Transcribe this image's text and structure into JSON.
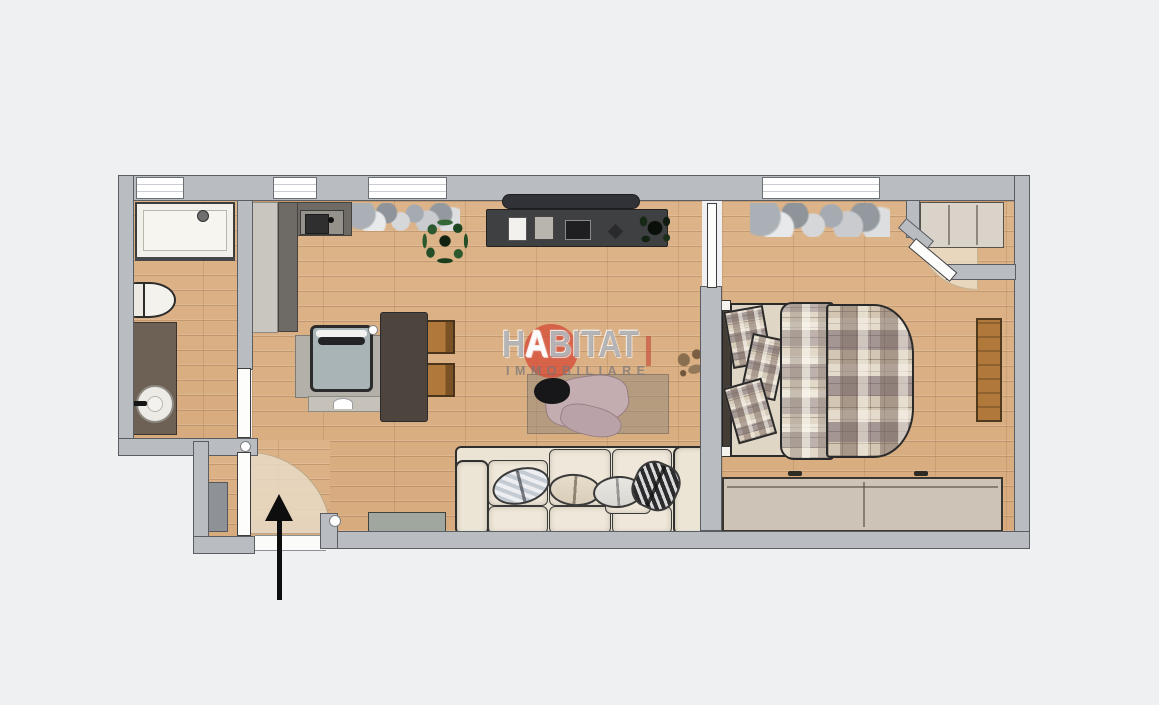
{
  "watermark": {
    "brand_part1": "H",
    "brand_part2": "A",
    "brand_part3": "BITAT",
    "subtitle": "IMMOBILIARE",
    "accent_color": "#d4503a"
  },
  "colors": {
    "background": "#eef0f2",
    "wall": "#b9bcc1",
    "wall_outline": "#5a5d61",
    "floor": "#d8ac7e",
    "accent_red": "#d4503a",
    "counter_dark": "#6e6a66",
    "sofa_cream": "#ebe4d5",
    "wood_chair": "#b0783a",
    "wardrobe_beige": "#cdc3b6",
    "plant_green": "#2c5a2e"
  },
  "plan": {
    "type": "apartment-floor-plan",
    "entry_direction": "up",
    "rooms": [
      {
        "name": "bathroom",
        "features": [
          "window",
          "shower",
          "toilet",
          "washbasin-vanity",
          "door"
        ]
      },
      {
        "name": "kitchen-living-room",
        "features": [
          "window",
          "window",
          "tall-cabinet",
          "kitchen-counter",
          "kitchen-sink",
          "peninsula",
          "armchair",
          "dining-table",
          "chair",
          "chair",
          "plant",
          "shoe-row",
          "tv",
          "tv-sideboard",
          "sideboard-plant",
          "rug",
          "blanket",
          "sofa",
          "cushions",
          "low-sideboard",
          "sliding-door"
        ]
      },
      {
        "name": "bedroom",
        "features": [
          "window",
          "double-bed",
          "pillows",
          "headboard",
          "shoe-row",
          "corner-closet",
          "closet-door",
          "wall-bench",
          "wardrobe"
        ]
      },
      {
        "name": "entrance-hall",
        "features": [
          "entry-door",
          "door-swing",
          "shoe-cabinet",
          "entry-arrow"
        ]
      }
    ]
  }
}
